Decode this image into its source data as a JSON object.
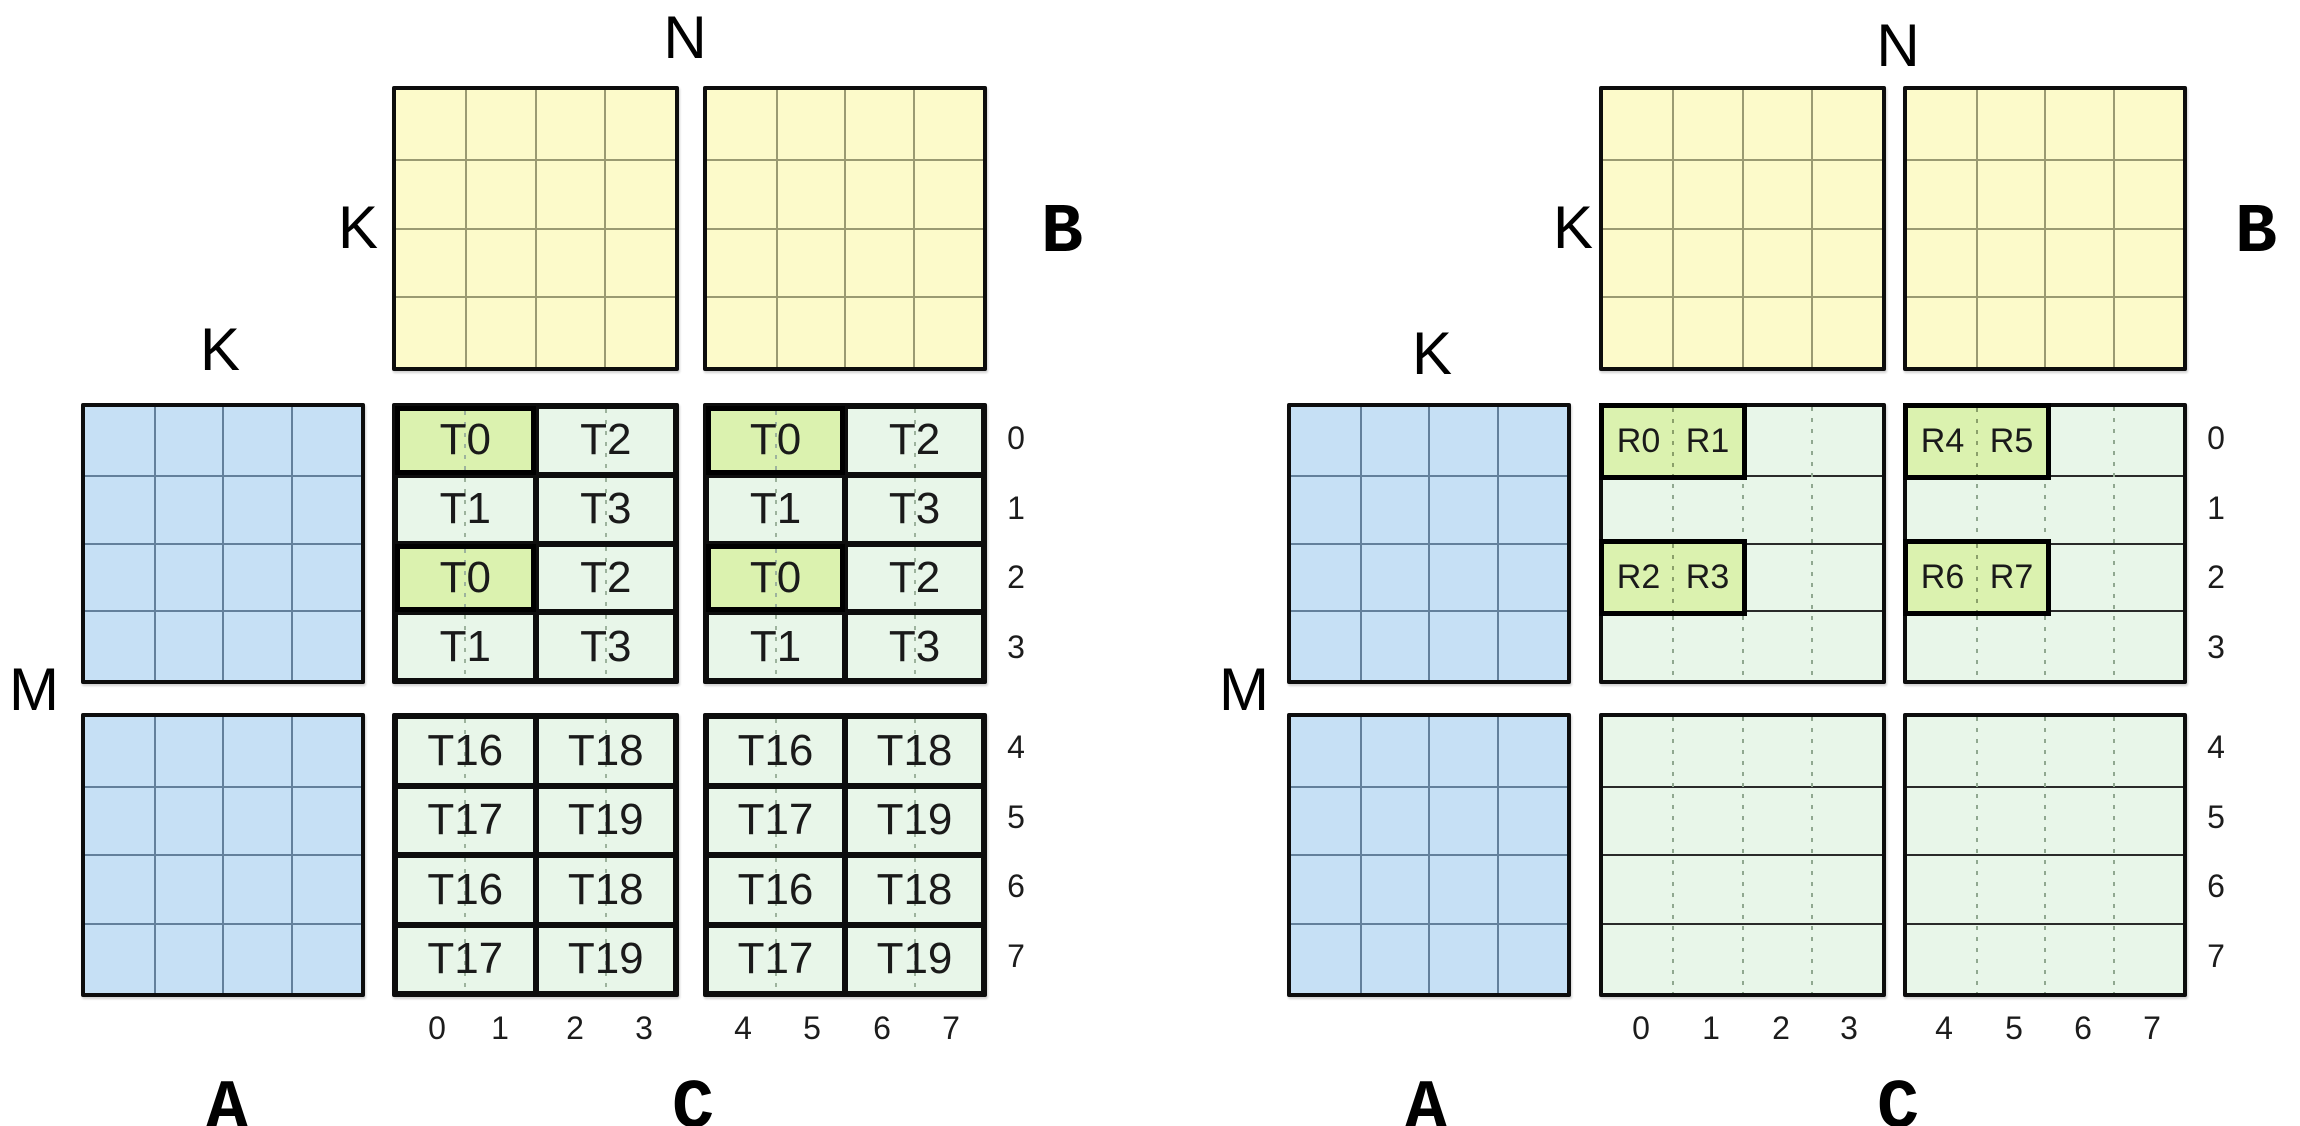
{
  "indices": {
    "rows": [
      "0",
      "1",
      "2",
      "3",
      "4",
      "5",
      "6",
      "7"
    ],
    "cols": [
      "0",
      "1",
      "2",
      "3",
      "4",
      "5",
      "6",
      "7"
    ]
  },
  "left_diagram": {
    "labels": {
      "n": "N",
      "k_beside_b": "K",
      "k_above_a": "K",
      "m": "M",
      "a": "A",
      "b": "B",
      "c": "C"
    },
    "c_tiles_top": [
      "T0",
      "T2",
      "T1",
      "T3",
      "T0",
      "T2",
      "T1",
      "T3"
    ],
    "c_tiles_bottom": [
      "T16",
      "T18",
      "T17",
      "T19",
      "T16",
      "T18",
      "T17",
      "T19"
    ]
  },
  "right_diagram": {
    "labels": {
      "n": "N",
      "k_beside_b": "K",
      "k_above_a": "K",
      "m": "M",
      "a": "A",
      "b": "B",
      "c": "C"
    },
    "c_registers_left_block": [
      "R0",
      "R1",
      "R2",
      "R3"
    ],
    "c_registers_right_block": [
      "R4",
      "R5",
      "R6",
      "R7"
    ]
  },
  "colors": {
    "matrix_a_fill": "#C6E0F5",
    "matrix_b_fill": "#FCFACA",
    "matrix_c_fill": "#E8F6E9",
    "highlight_fill": "#DBF2AF",
    "border": "#0d0d0d"
  }
}
